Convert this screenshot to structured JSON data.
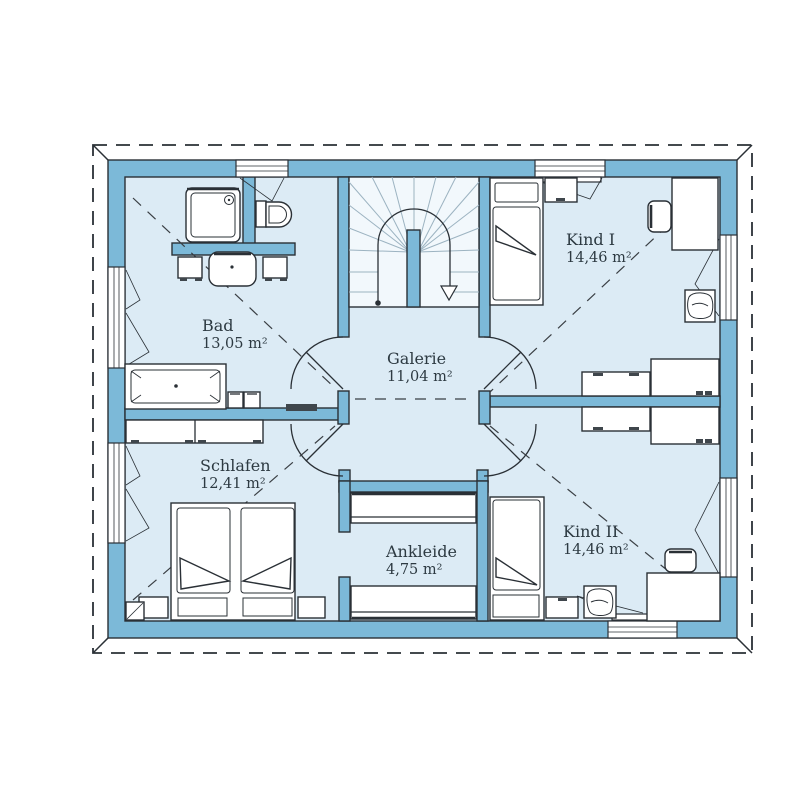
{
  "palette": {
    "wall": "#7cb9d8",
    "roomFill": "#dcebf5",
    "stairFill": "#f2f8fc",
    "line": "#2a3036",
    "text": "#2d3a42",
    "dashLine": "#3a3f44",
    "fanLine": "#9cb3c1",
    "accentDark": "#3f464c",
    "background": "#ffffff"
  },
  "rooms": [
    {
      "name": "Bad",
      "area": "13,05 m²"
    },
    {
      "name": "Galerie",
      "area": "11,04 m²"
    },
    {
      "name": "Kind I",
      "area": "14,46 m²"
    },
    {
      "name": "Schlafen",
      "area": "12,41 m²"
    },
    {
      "name": "Ankleide",
      "area": "4,75 m²"
    },
    {
      "name": "Kind II",
      "area": "14,46 m²"
    }
  ]
}
